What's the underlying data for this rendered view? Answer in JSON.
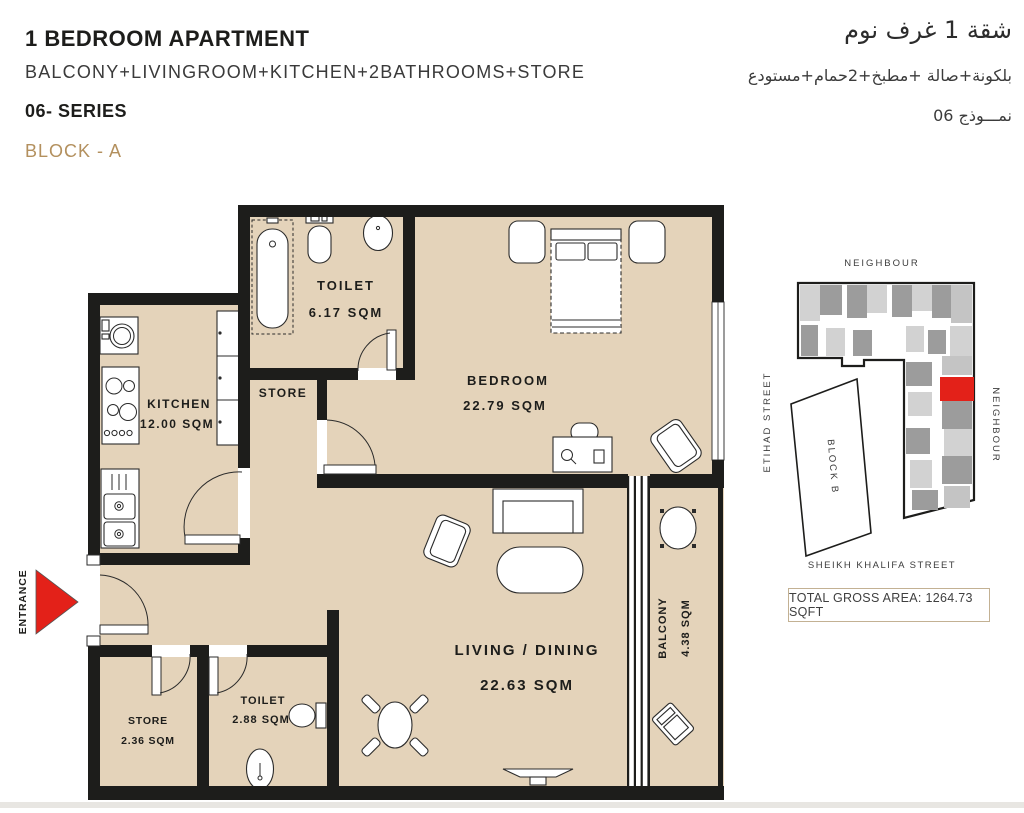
{
  "header": {
    "title": "1 BEDROOM APARTMENT",
    "subtitle": "BALCONY+LIVINGROOM+KITCHEN+2BATHROOMS+STORE",
    "series": "06- SERIES",
    "block": "BLOCK - A",
    "title_ar": "شقة 1 غرف نوم",
    "subtitle_ar": "بلكونة+صالة +مطبخ+2حمام+مستودع",
    "series_ar": "نمـــوذج 06"
  },
  "plan": {
    "entrance_label": "ENTRANCE",
    "rooms": {
      "toilet_main": {
        "label": "TOILET",
        "area": "6.17 SQM"
      },
      "store_upper": {
        "label": "STORE"
      },
      "kitchen": {
        "label": "KITCHEN",
        "area": "12.00 SQM"
      },
      "bedroom": {
        "label": "BEDROOM",
        "area": "22.79 SQM"
      },
      "living_dining": {
        "label": "LIVING / DINING",
        "area": "22.63 SQM"
      },
      "balcony": {
        "label": "BALCONY",
        "area": "4.38 SQM"
      },
      "store_lower": {
        "label": "STORE",
        "area": "2.36 SQM"
      },
      "toilet_lower": {
        "label": "TOILET",
        "area": "2.88 SQM"
      }
    }
  },
  "site_plan": {
    "neighbour_top": "NEIGHBOUR",
    "neighbour_right": "NEIGHBOUR",
    "street_left": "ETIHAD STREET",
    "street_bottom": "SHEIKH KHALIFA STREET",
    "block_b": "BLOCK B"
  },
  "footer": {
    "total_area": "TOTAL GROSS AREA: 1264.73 SQFT"
  },
  "colors": {
    "floor": "#e4d3ba",
    "wall": "#1d1d1b",
    "accent": "#b3905e",
    "highlight": "#e32119",
    "gray1": "#9c9c9c",
    "gray2": "#d2d2d2",
    "gray3": "#c4c4c4"
  }
}
